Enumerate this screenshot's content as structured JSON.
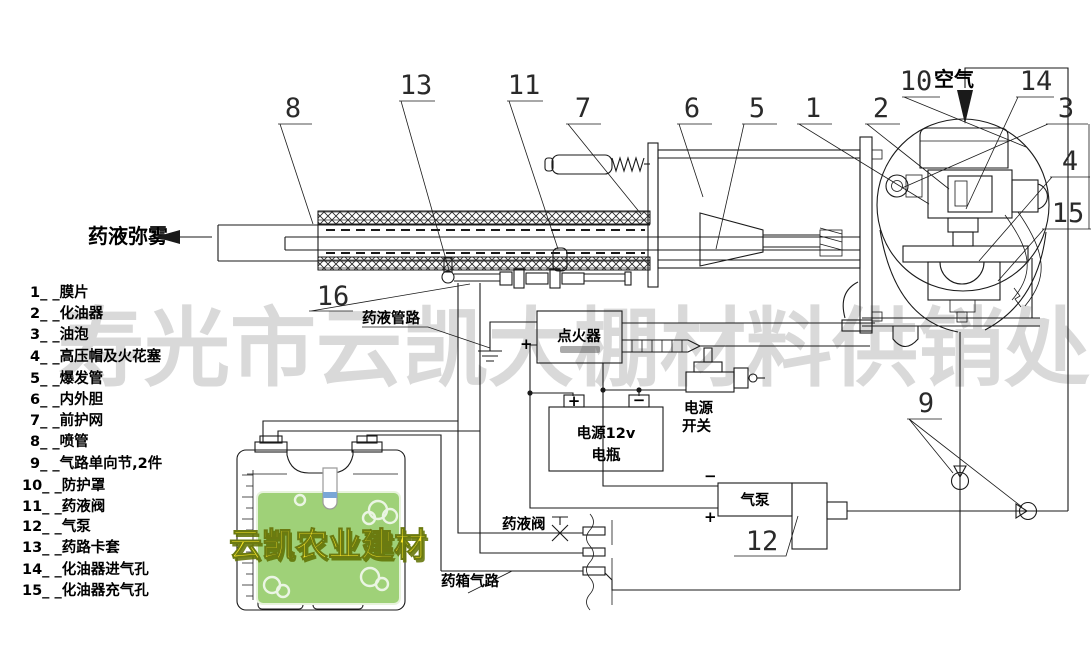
{
  "watermark": {
    "text": "寿光市云凯大棚材料供销处"
  },
  "brand_label": {
    "text": "云凯农业建材"
  },
  "labels": {
    "spray_mist": "药液弥雾",
    "air": "空气",
    "liquid_line": "药液管路",
    "liquid_valve": "药液阀",
    "tank_air_line": "药箱气路",
    "igniter": "点火器",
    "battery_line1": "电源12v",
    "battery_line2": "电瓶",
    "switch_line1": "电源",
    "switch_line2": "开关",
    "pump": "气泵",
    "plus": "+",
    "minus": "−"
  },
  "callouts": [
    "8",
    "13",
    "11",
    "7",
    "6",
    "5",
    "1",
    "2",
    "10",
    "14",
    "3",
    "4",
    "15",
    "9",
    "12",
    "16"
  ],
  "legend": {
    "items": [
      "1_ _膜片",
      "2_ _化油器",
      "3_ _油泡",
      "4_ _高压帽及火花塞",
      "5_ _爆发管",
      "6_ _内外胆",
      "7_ _前护网",
      "8_ _喷管",
      "9_ _气路单向节,2件",
      "10_ _防护罩",
      "11_ _药液阀",
      "12_ _气泵",
      "13_ _药路卡套",
      "14_ _化油器进气孔",
      "15_ _化油器充气孔"
    ]
  }
}
